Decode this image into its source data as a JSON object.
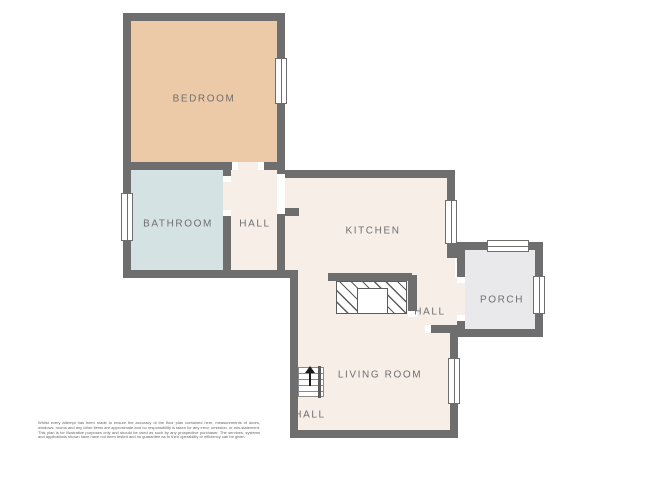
{
  "plan": {
    "title": "floor-plan",
    "rooms": {
      "bedroom": {
        "label": "BEDROOM"
      },
      "bathroom": {
        "label": "BATHROOM"
      },
      "hall_upper": {
        "label": "HALL"
      },
      "kitchen": {
        "label": "KITCHEN"
      },
      "porch": {
        "label": "PORCH"
      },
      "hall_middle": {
        "label": "HALL"
      },
      "living_room": {
        "label": "LIVING ROOM"
      },
      "hall_lower": {
        "label": "HALL"
      }
    },
    "features": {
      "stairs": "staircase-up-arrow",
      "fireplace": "chimney-breast-with-hearth",
      "windows": [
        "bedroom-right",
        "bathroom-left",
        "kitchen-right",
        "porch-top",
        "porch-right",
        "living-room-right"
      ]
    }
  },
  "colors": {
    "wall": "#6e6e6e",
    "floor-bedroom": "#ecc9a7",
    "floor-bathroom": "#d5e2e3",
    "floor-cream": "#f7eee8",
    "floor-porch": "#e9e9eb",
    "label": "#6f6f6f"
  },
  "disclaimer": "Whilst every attempt has been made to ensure the accuracy of the floor plan contained here, measurements of doors, windows, rooms and any other items are approximate and no responsibility is taken for any error, omission, or mis-statement. This plan is for illustrative purposes only and should be used as such by any prospective purchaser. The services, systems and applications shown have have not been tested and no guarantee as to their operability or efficiency can be given."
}
